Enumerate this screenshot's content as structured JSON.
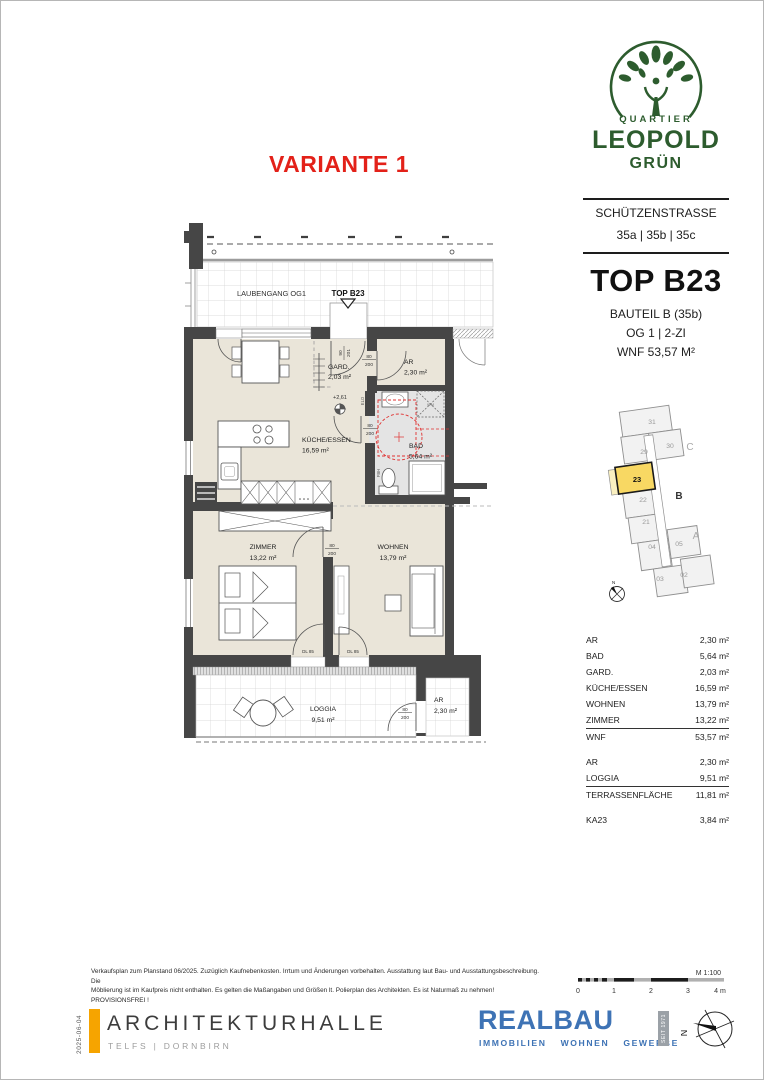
{
  "header": {
    "variante": "VARIANTE 1",
    "logo_top": "QUARTIER",
    "logo_main": "LEOPOLD",
    "logo_sub": "GRÜN",
    "street": "SCHÜTZENSTRASSE",
    "numbers": "35a | 35b | 35c",
    "unit": "TOP B23",
    "bauteil": "BAUTEIL B (35b)",
    "floor": "OG 1   |   2-ZI",
    "wnf": "WNF 53,57 M²"
  },
  "siteplan": {
    "u31": "31",
    "u30": "30",
    "u29": "29",
    "u23": "23",
    "u22": "22",
    "u21": "21",
    "u04": "04",
    "u05": "05",
    "u03": "03",
    "u02": "02",
    "wing_a": "A",
    "wing_b": "B",
    "wing_c": "C",
    "north": "N"
  },
  "plan": {
    "laubengang": "LAUBENGANG OG1",
    "marker": "TOP B23",
    "gard_name": "GARD.",
    "gard_area": "2,03 m²",
    "ar_top_name": "AR",
    "ar_top_area": "2,30 m²",
    "kueche_name": "KÜCHE/ESSEN",
    "kueche_area": "16,59 m²",
    "bad_name": "BAD",
    "bad_area": "5,64 m²",
    "zimmer_name": "ZIMMER",
    "zimmer_area": "13,22 m²",
    "wohnen_name": "WOHNEN",
    "wohnen_area": "13,79 m²",
    "loggia_name": "LOGGIA",
    "loggia_area": "9,51 m²",
    "ar_bot_name": "AR",
    "ar_bot_area": "2,30 m²",
    "level": "+2,61",
    "door_w": "80",
    "door_h": "200",
    "entry_w": "90",
    "entry_h": "201",
    "dl": "DL 85",
    "elo": "ELO",
    "fbh": "FBH",
    "wm": "WM"
  },
  "areas": {
    "rows": [
      {
        "label": "AR",
        "value": "2,30 m²"
      },
      {
        "label": "BAD",
        "value": "5,64 m²"
      },
      {
        "label": "GARD.",
        "value": "2,03 m²"
      },
      {
        "label": "KÜCHE/ESSEN",
        "value": "16,59 m²"
      },
      {
        "label": "WOHNEN",
        "value": "13,79 m²"
      },
      {
        "label": "ZIMMER",
        "value": "13,22 m²"
      },
      {
        "label": "WNF",
        "value": "53,57 m²"
      },
      {
        "label": "AR",
        "value": "2,30 m²"
      },
      {
        "label": "LOGGIA",
        "value": "9,51 m²"
      },
      {
        "label": "TERRASSENFLÄCHE",
        "value": "11,81 m²"
      },
      {
        "label": "KA23",
        "value": "3,84 m²"
      }
    ]
  },
  "footer": {
    "disclaimer1": "Verkaufsplan zum Planstand 06/2025. Zuzüglich Kaufnebenkosten. Irrtum und Änderungen vorbehalten. Ausstattung laut Bau- und Ausstattungsbeschreibung. Die",
    "disclaimer2": "Möblierung ist im Kaufpreis nicht enthalten. Es gelten die Maßangaben und Größen lt. Polierplan des Architekten. Es ist Naturmaß zu nehmen!   PROVISIONSFREI !",
    "date": "2025-06-04",
    "firm": "ARCHITEKTURHALLE",
    "firm_sub": "TELFS | DORNBIRN",
    "realbau": "REALBAU",
    "rb1": "IMMOBILIEN",
    "rb2": "WOHNEN",
    "rb3": "GEWERBE",
    "seit": "SEIT 1971",
    "scale_label": "M 1:100",
    "t0": "0",
    "t1": "1",
    "t2": "2",
    "t3": "3",
    "t4": "4 m",
    "north": "N"
  },
  "colors": {
    "logo_green": "#2d5c2e",
    "accent_red": "#e32119",
    "realbau_blue": "#3e73b5",
    "orange": "#f6a400",
    "wall": "#464646",
    "floor_beige": "#eae5d9",
    "bath_gray": "#e4e4e4",
    "highlight_yellow": "#f8d863",
    "plan_red_dash": "#e03030"
  }
}
